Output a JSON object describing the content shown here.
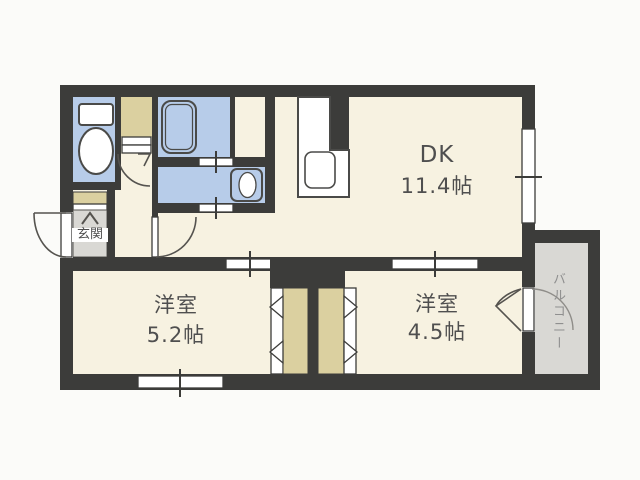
{
  "plan": {
    "rooms": {
      "dk": {
        "label": "DK",
        "size": "11.4帖"
      },
      "bedroom_left": {
        "label": "洋室",
        "size": "5.2帖"
      },
      "bedroom_right": {
        "label": "洋室",
        "size": "4.5帖"
      },
      "entrance": {
        "label": "玄関"
      },
      "balcony": {
        "label": "バルコニー"
      }
    },
    "fixtures": {
      "toilet": "toilet-icon",
      "bathtub": "bathtub-icon",
      "washbasin": "washbasin-icon",
      "kitchen_sink": "kitchen-sink-icon"
    },
    "colors": {
      "wall": "#3c3c3a",
      "room_fill": "#f7f2e1",
      "wet_area_fill": "#b7cce9",
      "closet_fill": "#dbd0a0",
      "entrance_fill": "#d9d8d4",
      "balcony_fill": "#d9d8d4",
      "fixture_fill": "#ffffff",
      "label_text": "#4f4f4f",
      "balcony_text": "#8f8f8f",
      "background": "#fbfbf9"
    }
  }
}
